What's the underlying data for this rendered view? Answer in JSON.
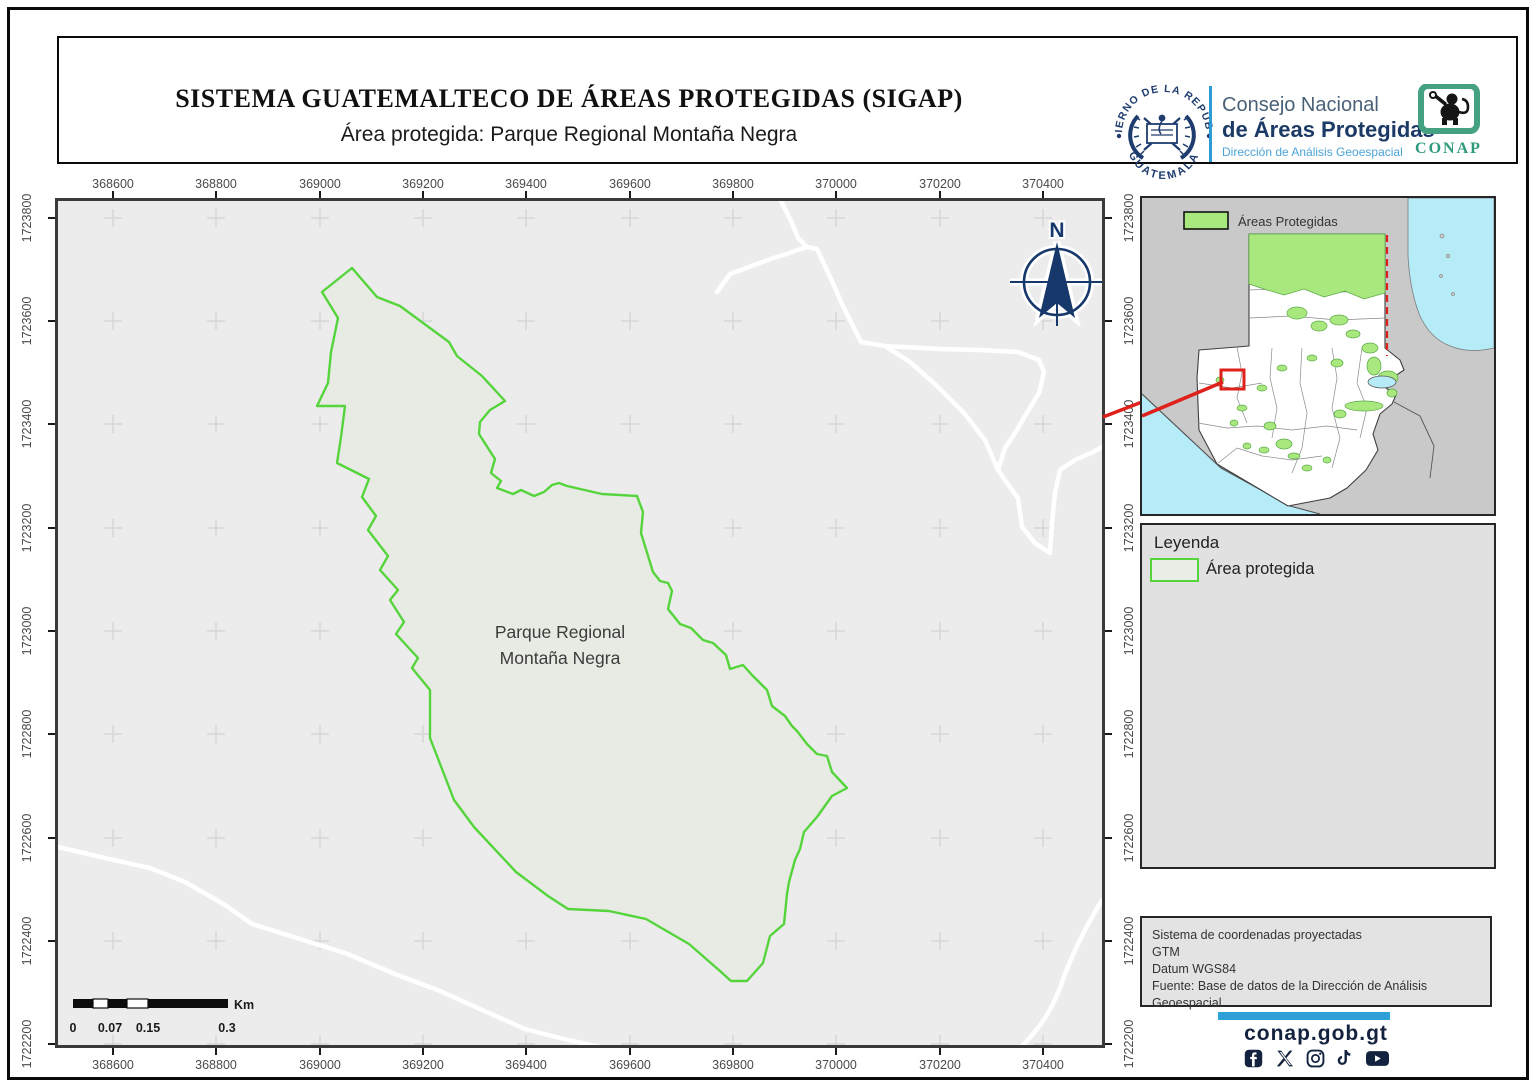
{
  "header": {
    "title": "SISTEMA GUATEMALTECO DE ÁREAS PROTEGIDAS  (SIGAP)",
    "subtitle": "Área protegida: Parque Regional Montaña Negra",
    "seal": {
      "top_text": "GOBIERNO DE LA REPÚBLICA",
      "bottom_text": "GUATEMALA"
    },
    "org": {
      "line1": "Consejo Nacional",
      "line2": "de Áreas Protegidas",
      "line3": "Dirección de Análisis Geoespacial"
    },
    "conap_logo_text": "CONAP"
  },
  "map": {
    "area_label_line1": "Parque Regional",
    "area_label_line2": "Montaña Negra",
    "north_label": "N",
    "x_ticks": [
      "368600",
      "368800",
      "369000",
      "369200",
      "369400",
      "369600",
      "369800",
      "370000",
      "370200",
      "370400"
    ],
    "y_ticks": [
      "1723800",
      "1723600",
      "1723400",
      "1723200",
      "1723000",
      "1722800",
      "1722600",
      "1722400",
      "1722200"
    ],
    "scalebar": {
      "labels": [
        "0",
        "0.07",
        "0.15",
        "0.3"
      ],
      "unit": "Km"
    }
  },
  "inset": {
    "legend_label": "Áreas Protegidas"
  },
  "legend_panel": {
    "title": "Leyenda",
    "item": "Área protegida"
  },
  "info_panel": {
    "line1": "Sistema de coordenadas proyectadas",
    "line2": "GTM",
    "line3": "Datum WGS84",
    "line4": "Fuente: Base de datos de la Dirección de Análisis Geoespacial"
  },
  "footer": {
    "website": "conap.gob.gt",
    "social": [
      "facebook",
      "x",
      "instagram",
      "tiktok",
      "youtube"
    ]
  },
  "colors": {
    "protected_outline_green": "#55d43c",
    "inset_green": "#a8e87e",
    "locator_red": "#e0201b",
    "navy": "#17386b",
    "accent_blue": "#2e9fd8"
  }
}
